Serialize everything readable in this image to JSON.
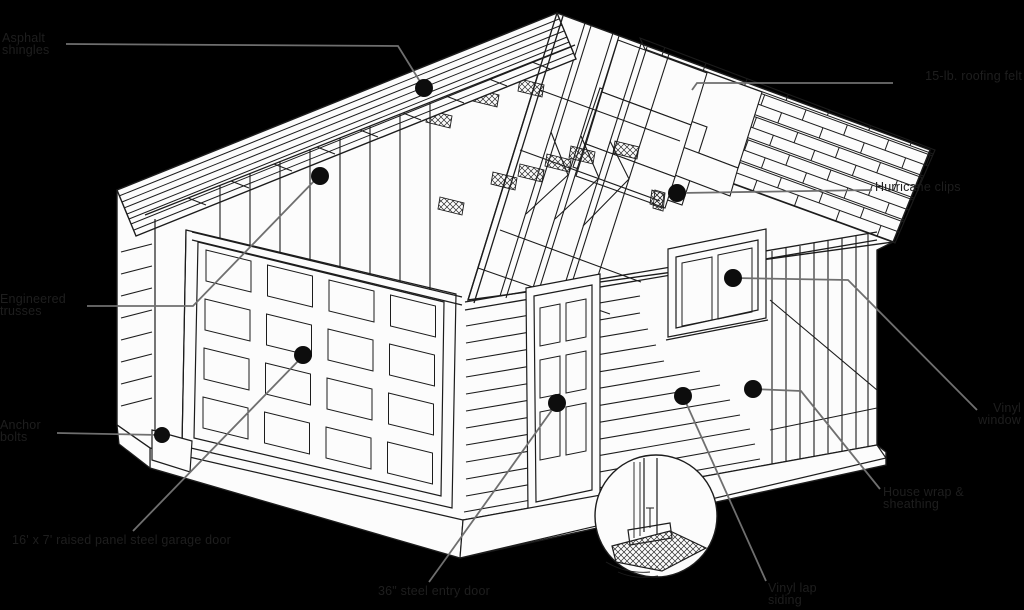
{
  "diagram": {
    "subject": "garage construction cutaway diagram",
    "colors": {
      "background": "#000000",
      "paper": "#fcfcfc",
      "ink": "#1c1c1c",
      "leader_line": "#6f6f6f",
      "label_text": "#1e1e1e",
      "callout_dot": "#0d0d0d"
    }
  },
  "labels": [
    {
      "id": "shingles",
      "lines": [
        "Asphalt",
        "shingles"
      ]
    },
    {
      "id": "roofing-felt",
      "lines": [
        "15-lb. roofing felt"
      ]
    },
    {
      "id": "hurricane-clips",
      "lines": [
        "Hurricane clips"
      ]
    },
    {
      "id": "window",
      "lines": [
        "Vinyl",
        "window"
      ]
    },
    {
      "id": "house-wrap",
      "lines": [
        "House wrap &",
        "sheathing"
      ]
    },
    {
      "id": "siding",
      "lines": [
        "Vinyl lap",
        "siding"
      ]
    },
    {
      "id": "entry-door",
      "lines": [
        "36\" steel entry door"
      ]
    },
    {
      "id": "garage-door",
      "lines": [
        "16' x 7' raised panel steel garage door"
      ]
    },
    {
      "id": "anchor-bolts",
      "lines": [
        "Anchor",
        "bolts"
      ]
    },
    {
      "id": "trusses",
      "lines": [
        "Engineered",
        "trusses"
      ]
    }
  ]
}
